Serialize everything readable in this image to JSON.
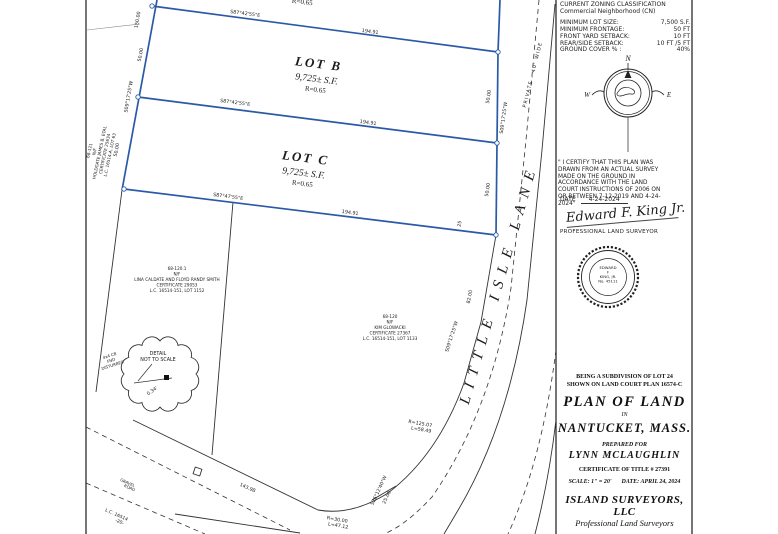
{
  "lots": {
    "a_partial_ratio": "R=0.65",
    "b": {
      "name": "LOT B",
      "area": "9,725± S.F.",
      "ratio": "R=0.65"
    },
    "c": {
      "name": "LOT C",
      "area": "9,725± S.F.",
      "ratio": "R=0.65"
    }
  },
  "road": {
    "name": "LITTLE ISLE LANE",
    "note": "PRIVATE - 40' WIDE"
  },
  "bearings": {
    "b_top": "S87°42'55\"E",
    "b_top_len": "194.91",
    "b_mid": "S87°42'55\"E",
    "b_mid_len": "194.91",
    "b_bot": "S87°47'55\"E",
    "b_bot_len": "194.91",
    "left_150": "150.00",
    "left_50a": "50.00",
    "left_brg": "S09°17'25\"W",
    "left_50b": "50.00",
    "right_50a": "50.00",
    "right_brg_a": "S09°17'25\"W",
    "right_50b": "50.00",
    "right_25": "25",
    "right_82": "82.00",
    "right_brg_b": "S09°17'25\"W",
    "gravel_len": "143.98",
    "curve1_r": "R=125.07",
    "curve1_l": "L=58.49",
    "curve2_r": "R=30.00",
    "curve2_l": "L=47.12",
    "tick_brg": "S26°12'40\"W",
    "tick_len": "25.00"
  },
  "neighbors": {
    "holdgate": {
      "lines": [
        "68-121",
        "N/F",
        "HOLDGATE JAMES B. ETAL",
        "CERTIFICATE 25634",
        "L.C. 16514-A, LOT 63"
      ]
    },
    "lina": {
      "lines": [
        "68-120.1",
        "N/F",
        "LINA CALDATE AND FLOYD RANDY SMITH",
        "CERTIFICATE 29053",
        "L.C. 16514-151, LOT 1152"
      ]
    },
    "kim": {
      "lines": [
        "68-120",
        "N/F",
        "KIM GLOWACKI",
        "CERTIFICATE 27367",
        "L.C. 16514-151, LOT 1133"
      ]
    }
  },
  "detail": {
    "title": "DETAIL",
    "subtitle": "NOT TO SCALE",
    "offset": "0.34'",
    "monument": [
      "4x4 CB",
      "FND",
      "DISTURBED"
    ]
  },
  "bottom_left": {
    "road_name_1": "GRAVEL",
    "road_name_2": "ROAD",
    "lc": "L.C. 16514",
    "lc2": "-20-"
  },
  "zoning": {
    "title": "CURRENT ZONING CLASSIFICATION",
    "subtitle": "Commercial Neighborhood (CN)",
    "rows": [
      {
        "label": "MINIMUM LOT SIZE:",
        "value": "7,500 S.F."
      },
      {
        "label": "MINIMUM FRONTAGE:",
        "value": "50 FT"
      },
      {
        "label": "FRONT YARD SETBACK:",
        "value": "10 FT"
      },
      {
        "label": "REAR/SIDE SETBACK:",
        "value": "10 FT /5 FT"
      },
      {
        "label": "GROUND COVER % :",
        "value": "40%"
      }
    ]
  },
  "compass": {
    "n": "N",
    "w": "W",
    "e": "E"
  },
  "certification": {
    "statement": "\" I CERTIFY THAT THIS PLAN WAS DRAWN FROM AN ACTUAL SURVEY MADE ON THE GROUND IN ACCORDANCE WITH THE LAND COURT INSTRUCTIONS OF 2006 ON OR BETWEEN 7-12-2019 AND 4-24-2024\"",
    "date_label": "DATE",
    "date_value": "4-24-2024",
    "signature": "Edward F. King Jr.",
    "signer_title": "PROFESSIONAL LAND SURVEYOR"
  },
  "seal": {
    "lines": [
      "EDWARD",
      "F",
      "KING, JR.",
      "No. 45111"
    ]
  },
  "title_block": {
    "sub1": "BEING A SUBDIVISION OF LOT 24",
    "sub2": "SHOWN ON LAND COURT PLAN 16574-C",
    "title": "PLAN OF LAND",
    "in_word": "IN",
    "place": "NANTUCKET, MASS.",
    "prepared": "PREPARED FOR",
    "client": "LYNN MCLAUGHLIN",
    "cert": "CERTIFICATE OF TITLE # 27391",
    "scale": "SCALE: 1\" = 20'",
    "date": "DATE: APRIL 24, 2024",
    "firm": "ISLAND SURVEYORS, LLC",
    "firm_sub": "Professional Land Surveyors"
  }
}
